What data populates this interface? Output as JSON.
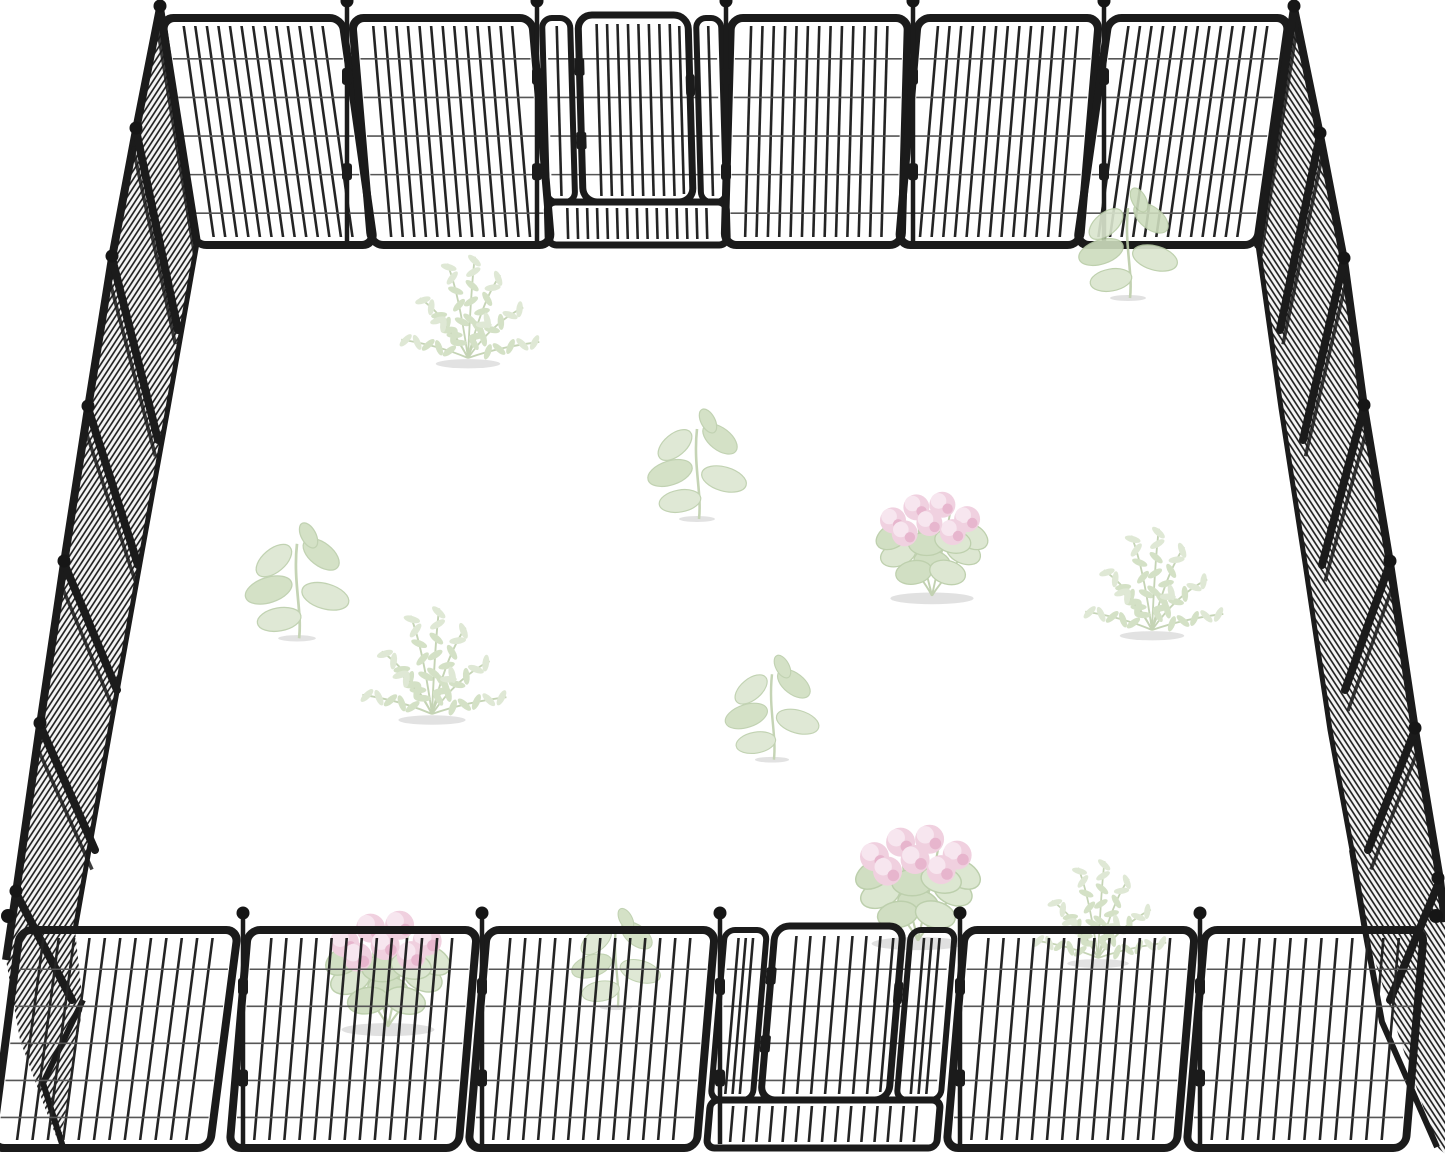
{
  "scene": {
    "title": "Black metal heavy-duty pet playpen fence arranged as a square enclosure with a gate door in the back wall and front wall, faint pale plants scattered inside on a white floor",
    "background": "#ffffff",
    "colors": {
      "frame": "#1b1b1b",
      "bar": "#242424",
      "wire": "#565656",
      "mesh_line": "#191919",
      "mesh_bg": "#f5f5f5",
      "ball": "#161616",
      "plant_leaf": "#dae5ce",
      "plant_leaf2": "#cddcbd",
      "plant_outline": "#b7cba5",
      "plant_stem": "#bccda9",
      "pink": "#efcddd",
      "pink_dark": "#e5afc9",
      "pink_light": "#f7e4ee",
      "shadow": "#dedede"
    }
  },
  "pen": {
    "frame_stroke": 8,
    "bar_stroke": 2.6,
    "wire_stroke": 1.6,
    "wire_fractions": [
      0.18,
      0.35,
      0.52,
      0.69,
      0.86
    ],
    "back_wall": {
      "y_top": 18,
      "y_bot": 245,
      "vp_x": 725,
      "skew_k": 0.0003,
      "bar_gap": 11.5,
      "panels": [
        [
          162,
          342
        ],
        [
          352,
          532
        ],
        [
          731,
          908
        ],
        [
          918,
          1099
        ],
        [
          1109,
          1289
        ]
      ],
      "poles": [
        347,
        537,
        726,
        913,
        1104
      ],
      "corner_balls": [],
      "gate": {
        "x0": 542,
        "x1": 721,
        "door_x0": 578,
        "door_x1": 688,
        "sill_h": 43,
        "door_raise": 3
      }
    },
    "front_wall": {
      "y_top": 930,
      "y_bot": 1148,
      "skew_tan": -0.085,
      "bar_gap": 15,
      "panels": [
        [
          20,
          238,
          -0.13
        ],
        [
          248,
          477
        ],
        [
          487,
          715
        ],
        [
          965,
          1195
        ],
        [
          1205,
          1424
        ]
      ],
      "poles": [
        243,
        482,
        720,
        960,
        1200
      ],
      "corner_balls": [
        [
          8,
          916
        ],
        [
          1436,
          916
        ]
      ],
      "gate": {
        "x0": 725,
        "x1": 955,
        "door_x0": 775,
        "door_x1": 903,
        "sill_h": 48,
        "door_raise": 4
      }
    },
    "left_wall": {
      "band": "160,8 136,130 112,258 88,408 64,563 40,725 16,893 6,960 20,1040 45,1108 60,1146 83,1005 75,930 89,850 111,725 140,563 168,408 180,330 197,243",
      "outer": "160,8 136,130 112,258 88,408 64,563 40,725 16,893 6,960",
      "floor": "197,243 168,408 140,563 111,725 89,850 75,930",
      "tail": "83,1000 43,1083 63,1147",
      "hinges": [
        [
          160,
          8,
          197,
          243
        ],
        [
          136,
          130,
          178,
          330
        ],
        [
          112,
          258,
          158,
          440
        ],
        [
          88,
          408,
          138,
          565
        ],
        [
          64,
          563,
          117,
          690
        ],
        [
          40,
          725,
          95,
          850
        ],
        [
          16,
          893,
          72,
          1000
        ]
      ],
      "balls": [
        [
          160,
          6
        ],
        [
          136,
          128
        ],
        [
          112,
          256
        ],
        [
          88,
          406
        ],
        [
          64,
          561
        ],
        [
          40,
          723
        ],
        [
          16,
          891
        ]
      ]
    },
    "right_wall": {
      "band": "1294,8 1320,135 1344,260 1364,407 1390,563 1415,730 1440,880 1445,922 1445,1154 1437,1147 1400,1040 1365,930 1352,850 1330,730 1305,563 1281,408 1258,245",
      "outer": "1294,8 1320,135 1344,260 1364,407 1390,563 1415,730 1440,880 1445,922",
      "floor": "1258,245 1281,408 1305,563 1330,730 1352,850 1365,930",
      "tail": "1352,850 1365,930 1382,1022 1437,1147",
      "hinges": [
        [
          1294,
          8,
          1258,
          245
        ],
        [
          1320,
          135,
          1280,
          330
        ],
        [
          1344,
          260,
          1303,
          440
        ],
        [
          1364,
          407,
          1322,
          565
        ],
        [
          1390,
          563,
          1345,
          690
        ],
        [
          1415,
          730,
          1368,
          850
        ],
        [
          1440,
          880,
          1390,
          1000
        ]
      ],
      "balls": [
        [
          1294,
          6
        ],
        [
          1320,
          133
        ],
        [
          1344,
          258
        ],
        [
          1364,
          405
        ],
        [
          1390,
          561
        ],
        [
          1415,
          728
        ],
        [
          1438,
          878
        ]
      ]
    }
  },
  "plants": [
    {
      "t": "zz",
      "x": 468,
      "y": 358,
      "s": 1.15,
      "o": 0.85
    },
    {
      "t": "sprout",
      "x": 697,
      "y": 473,
      "s": 1.0,
      "o": 0.85
    },
    {
      "t": "sprout",
      "x": 297,
      "y": 590,
      "s": 1.05,
      "o": 0.85
    },
    {
      "t": "pink",
      "x": 932,
      "y": 536,
      "s": 1.3,
      "o": 0.9
    },
    {
      "t": "zz",
      "x": 1152,
      "y": 630,
      "s": 1.15,
      "o": 0.85
    },
    {
      "t": "sprout",
      "x": 1128,
      "y": 252,
      "s": 1.0,
      "o": 0.9
    },
    {
      "t": "zz",
      "x": 432,
      "y": 714,
      "s": 1.2,
      "o": 0.85
    },
    {
      "t": "sprout",
      "x": 772,
      "y": 716,
      "s": 0.95,
      "o": 0.85
    },
    {
      "t": "pink",
      "x": 918,
      "y": 874,
      "s": 1.45,
      "o": 0.92
    },
    {
      "t": "zz",
      "x": 1098,
      "y": 958,
      "s": 1.1,
      "o": 0.85
    },
    {
      "t": "pink",
      "x": 388,
      "y": 960,
      "s": 1.45,
      "o": 0.92
    },
    {
      "t": "sprout",
      "x": 616,
      "y": 966,
      "s": 0.9,
      "o": 0.85
    }
  ]
}
